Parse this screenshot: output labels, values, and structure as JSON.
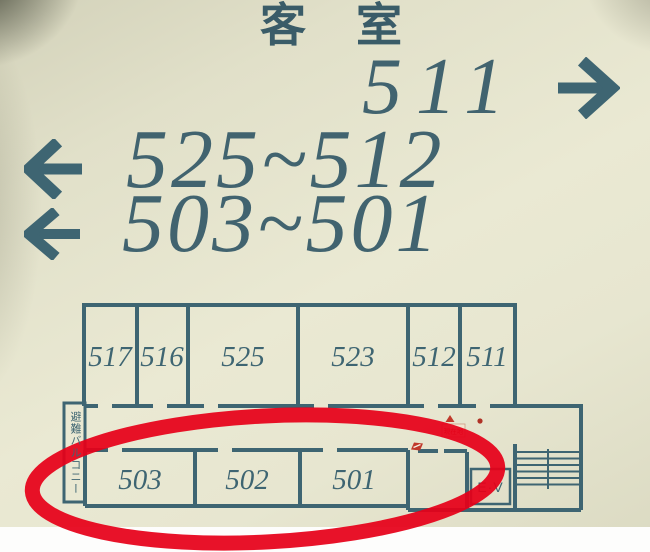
{
  "sign": {
    "title": "客　室",
    "directions": [
      {
        "rooms": "511",
        "arrow": "right"
      },
      {
        "rooms": "525~512",
        "arrow": "left"
      },
      {
        "rooms": "503~501",
        "arrow": "left"
      }
    ],
    "floorplan": {
      "top_rooms": [
        "517",
        "516",
        "525",
        "523",
        "512",
        "511"
      ],
      "bottom_rooms": [
        "503",
        "502",
        "501"
      ],
      "elevator_label": "E·V",
      "balcony_label": "避難バルコニー",
      "marker_label": "現在地",
      "features": [
        "staircase-icon",
        "you-are-here-marker",
        "fire-equipment-icon"
      ]
    },
    "annotation": {
      "shape": "red-ellipse",
      "circled_rooms": [
        "503",
        "502",
        "501"
      ]
    },
    "colors": {
      "teal": "#3e6572",
      "sign_background": "#e7e6d0",
      "annotation_red": "#e60019",
      "marker_red": "#b03226"
    }
  }
}
